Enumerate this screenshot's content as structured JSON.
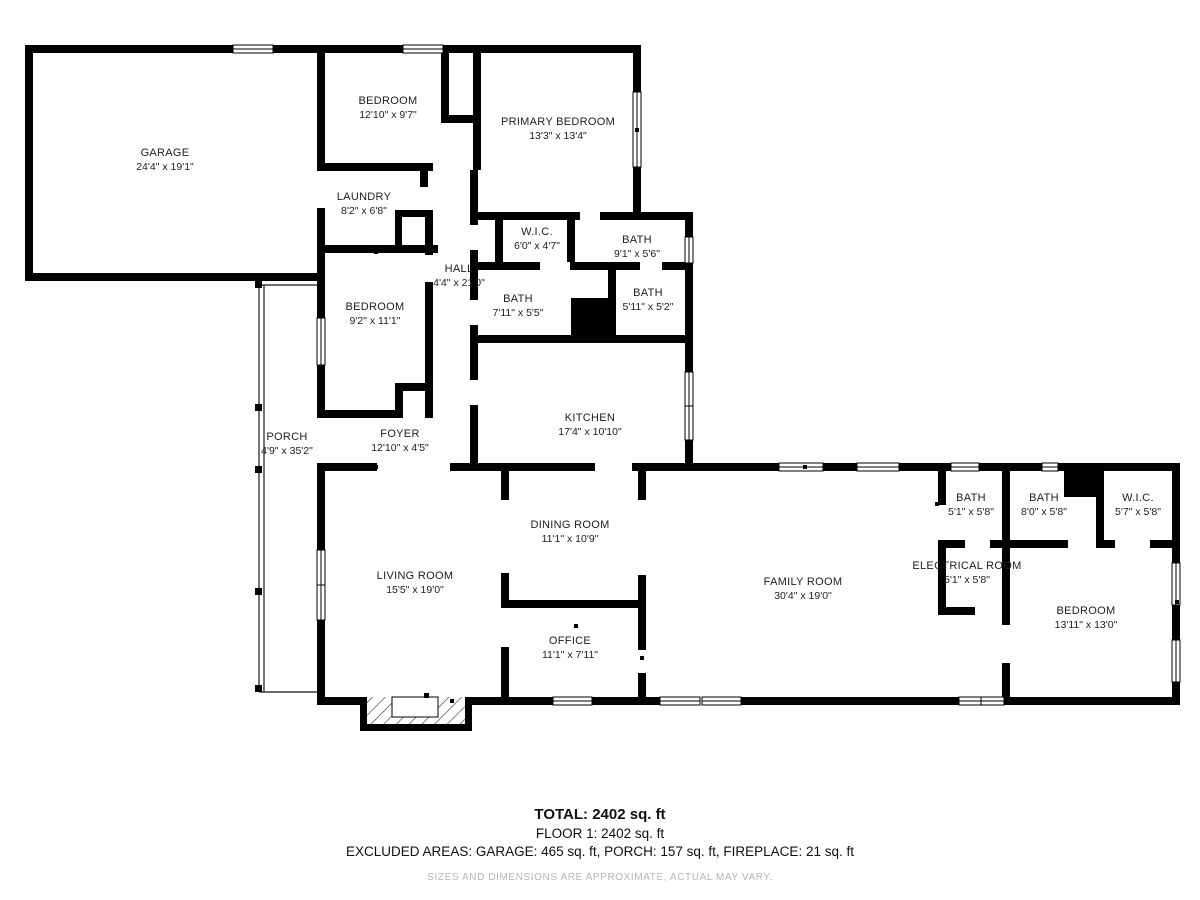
{
  "rooms": [
    {
      "name": "GARAGE",
      "dims": "24'4\" x 19'1\""
    },
    {
      "name": "BEDROOM",
      "dims": "12'10\" x 9'7\""
    },
    {
      "name": "PRIMARY BEDROOM",
      "dims": "13'3\" x 13'4\""
    },
    {
      "name": "LAUNDRY",
      "dims": "8'2\" x 6'8\""
    },
    {
      "name": "W.I.C.",
      "dims": "6'0\" x 4'7\""
    },
    {
      "name": "BATH",
      "dims": "9'1\" x 5'6\""
    },
    {
      "name": "HALL",
      "dims": "4'4\" x 21'0\""
    },
    {
      "name": "BEDROOM",
      "dims": "9'2\" x 11'1\""
    },
    {
      "name": "BATH",
      "dims": "7'11\" x 5'5\""
    },
    {
      "name": "BATH",
      "dims": "5'11\" x 5'2\""
    },
    {
      "name": "KITCHEN",
      "dims": "17'4\" x 10'10\""
    },
    {
      "name": "PORCH",
      "dims": "4'9\" x 35'2\""
    },
    {
      "name": "FOYER",
      "dims": "12'10\" x 4'5\""
    },
    {
      "name": "LIVING ROOM",
      "dims": "15'5\" x 19'0\""
    },
    {
      "name": "DINING ROOM",
      "dims": "11'1\" x 10'9\""
    },
    {
      "name": "OFFICE",
      "dims": "11'1\" x 7'11\""
    },
    {
      "name": "FAMILY ROOM",
      "dims": "30'4\" x 19'0\""
    },
    {
      "name": "BATH",
      "dims": "5'1\" x 5'8\""
    },
    {
      "name": "BATH",
      "dims": "8'0\" x 5'8\""
    },
    {
      "name": "W.I.C.",
      "dims": "5'7\" x 5'8\""
    },
    {
      "name": "ELECTRICAL ROOM",
      "dims": "5'1\" x 5'8\""
    },
    {
      "name": "BEDROOM",
      "dims": "13'11\" x 13'0\""
    }
  ],
  "summary": {
    "total": "TOTAL: 2402 sq. ft",
    "floor": "FLOOR 1: 2402 sq. ft",
    "excluded": "EXCLUDED AREAS: GARAGE: 465 sq. ft, PORCH: 157 sq. ft, FIREPLACE: 21 sq. ft",
    "disclaimer": "SIZES AND DIMENSIONS ARE APPROXIMATE, ACTUAL MAY VARY."
  },
  "colors": {
    "wall": "#000000",
    "background": "#ffffff",
    "disclaimer_text": "#b6b6b6"
  }
}
